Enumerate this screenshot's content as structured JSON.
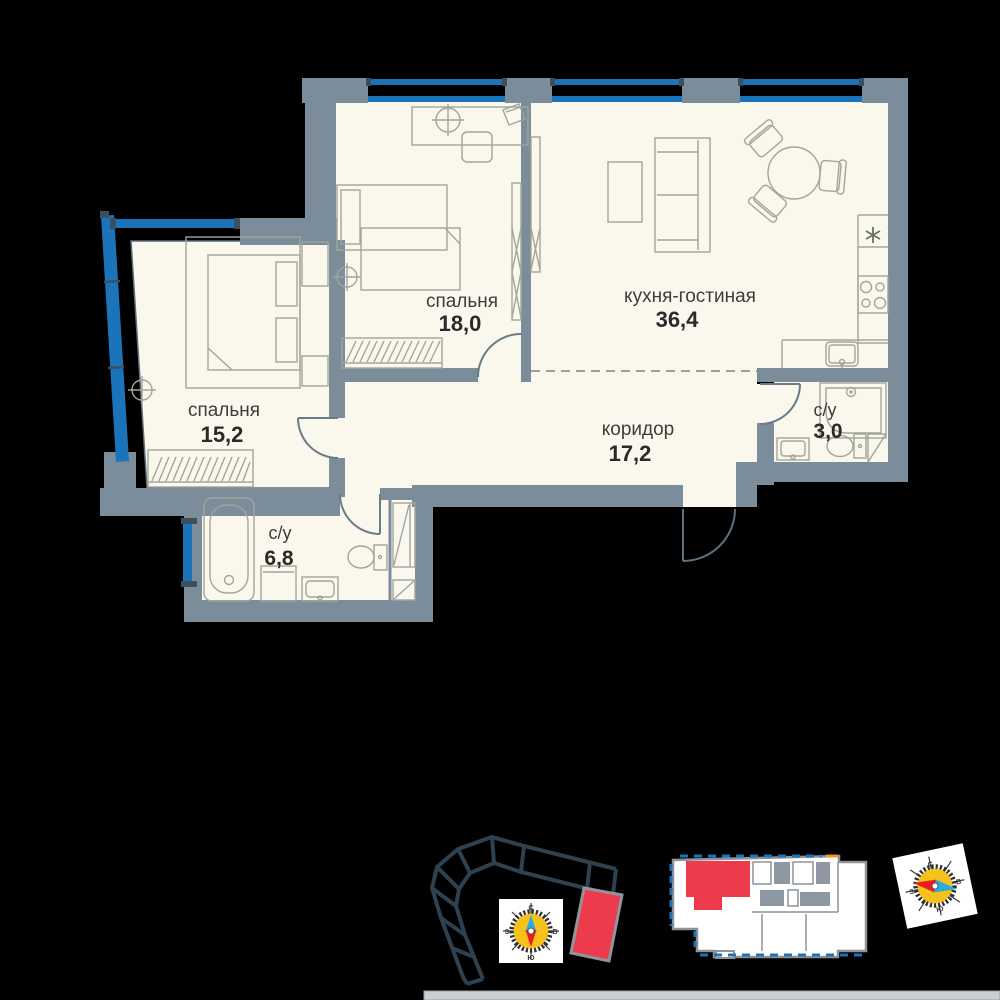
{
  "plan": {
    "rooms": [
      {
        "key": "bedroom_18",
        "label": "спальня",
        "area": "18,0"
      },
      {
        "key": "kitchen_living",
        "label": "кухня-гостиная",
        "area": "36,4"
      },
      {
        "key": "bedroom_15",
        "label": "спальня",
        "area": "15,2"
      },
      {
        "key": "corridor",
        "label": "коридор",
        "area": "17,2"
      },
      {
        "key": "bathroom_3",
        "label": "с/у",
        "area": "3,0"
      },
      {
        "key": "bathroom_6",
        "label": "с/у",
        "area": "6,8"
      }
    ]
  },
  "compass": {
    "north": "С",
    "east": "В",
    "south": "Ю",
    "west": "З"
  },
  "icons": {
    "fridge": "snowflake-asterisk",
    "compass": "compass-rose",
    "unit_marker": "red-unit-highlight"
  },
  "colors": {
    "wall": "#7b8d9b",
    "floor": "#faf8ec",
    "window_blue": "#1b74ba",
    "highlight_red": "#ee3a4d",
    "footprint_outline": "#2e4150",
    "compass_yellow": "#f5c21b",
    "compass_blue": "#29abe2",
    "compass_red": "#ed1c24",
    "background": "#000000"
  }
}
